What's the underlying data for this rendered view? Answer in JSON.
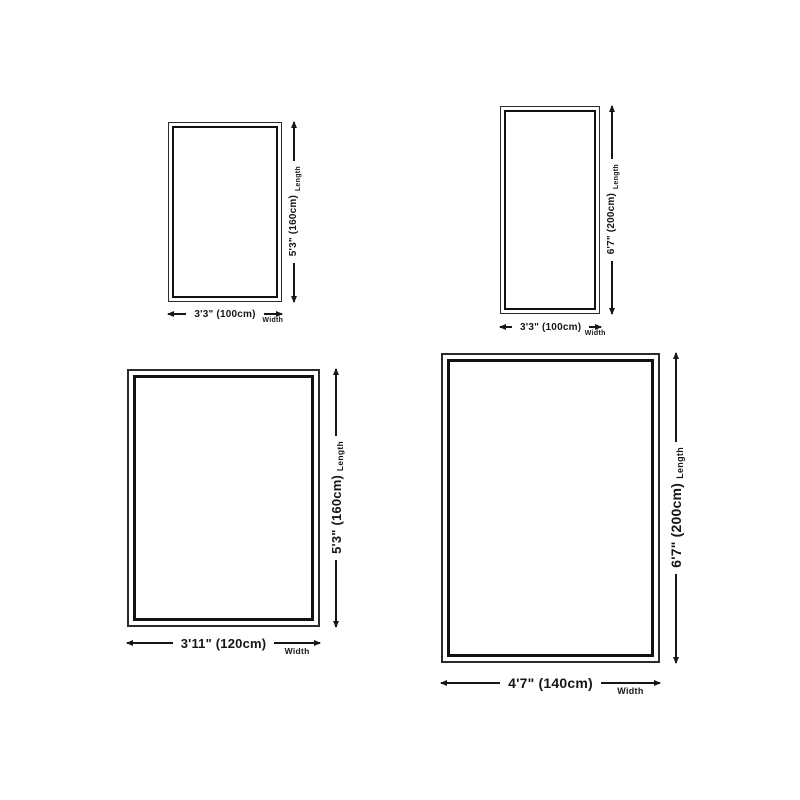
{
  "page": {
    "background": "#ffffff",
    "line_color": "#161616"
  },
  "diagrams": [
    {
      "length_text": "5'3\" (160cm)",
      "length_label": "Length",
      "width_text": "3'3\" (100cm)",
      "width_label": "Width"
    },
    {
      "length_text": "6'7\" (200cm)",
      "length_label": "Length",
      "width_text": "3'3\" (100cm)",
      "width_label": "Width"
    },
    {
      "length_text": "5'3\" (160cm)",
      "length_label": "Length",
      "width_text": "3'11\" (120cm)",
      "width_label": "Width"
    },
    {
      "length_text": "6'7\" (200cm)",
      "length_label": "Length",
      "width_text": "4'7\" (140cm)",
      "width_label": "Width"
    }
  ]
}
